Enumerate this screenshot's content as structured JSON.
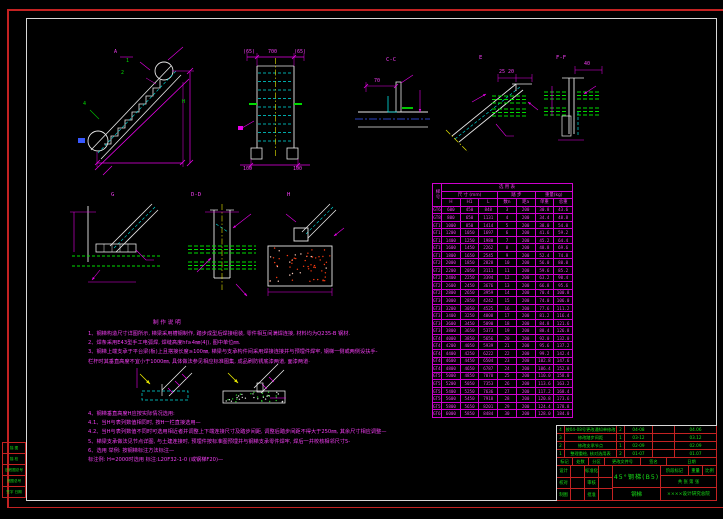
{
  "colors": {
    "background": "#000000",
    "linework_white": "#e8e8e8",
    "dimension_magenta": "#e800e8",
    "annotation_green": "#00dc00",
    "hidden_cyan": "#00e0e0",
    "centerline_yellow": "#e8e800",
    "frame_red": "#c42222",
    "titleblock_text_green": "#18e018",
    "table_magenta": "#f040f0"
  },
  "labels": {
    "elev_mark": "A",
    "balloon_1": "1",
    "balloon_2": "2",
    "balloon_4": "4",
    "dim_h": "H",
    "front_top_left": "(65)",
    "front_top_mid": "700",
    "front_top_right": "(65)",
    "front_bottom_left": "100",
    "front_bottom_right": "100",
    "sec_cc": "C-C",
    "sec_e": "E",
    "sec_ff": "F-F",
    "sec_g": "G",
    "sec_dd": "D-D",
    "sec_h": "H",
    "dim_cc": "70",
    "dim_e": "25 20",
    "dim_ff": "40"
  },
  "table": {
    "side_title": "梯号",
    "title": "选  用  表",
    "group_dims": "尺 寸 (mm)",
    "group_steps": "踏  步",
    "group_weight": "重量(kg)",
    "cols": [
      "H",
      "H1",
      "L",
      "数n",
      "距a",
      "单重",
      "总重"
    ],
    "rows": [
      [
        "GT6",
        "600",
        "450",
        "848",
        "3",
        "200",
        "30.8",
        "43.6"
      ],
      [
        "GT8",
        "800",
        "650",
        "1131",
        "4",
        "200",
        "34.4",
        "48.8"
      ],
      [
        "GT10",
        "1000",
        "850",
        "1414",
        "5",
        "200",
        "38.0",
        "54.0"
      ],
      [
        "GT12",
        "1200",
        "1050",
        "1697",
        "6",
        "200",
        "41.6",
        "59.2"
      ],
      [
        "GT14",
        "1400",
        "1250",
        "1980",
        "7",
        "200",
        "45.2",
        "64.4"
      ],
      [
        "GT16",
        "1600",
        "1450",
        "2262",
        "8",
        "200",
        "48.8",
        "69.6"
      ],
      [
        "GT18",
        "1800",
        "1650",
        "2545",
        "9",
        "200",
        "52.4",
        "74.8"
      ],
      [
        "GT20",
        "2000",
        "1850",
        "2828",
        "10",
        "200",
        "56.0",
        "80.0"
      ],
      [
        "GT22",
        "2200",
        "2050",
        "3111",
        "11",
        "200",
        "59.6",
        "85.2"
      ],
      [
        "GT24",
        "2400",
        "2250",
        "3394",
        "12",
        "200",
        "63.2",
        "90.4"
      ],
      [
        "GT26",
        "2600",
        "2450",
        "3676",
        "13",
        "200",
        "66.8",
        "95.6"
      ],
      [
        "GT28",
        "2800",
        "2650",
        "3959",
        "14",
        "200",
        "70.4",
        "100.8"
      ],
      [
        "GT30",
        "3000",
        "2850",
        "4242",
        "15",
        "200",
        "74.0",
        "106.0"
      ],
      [
        "GT32",
        "3200",
        "3050",
        "4525",
        "16",
        "200",
        "77.6",
        "111.2"
      ],
      [
        "GT34",
        "3400",
        "3250",
        "4808",
        "17",
        "200",
        "81.2",
        "116.4"
      ],
      [
        "GT36",
        "3600",
        "3450",
        "5090",
        "18",
        "200",
        "84.8",
        "121.6"
      ],
      [
        "GT38",
        "3800",
        "3650",
        "5373",
        "19",
        "200",
        "88.4",
        "126.8"
      ],
      [
        "GT40",
        "4000",
        "3850",
        "5656",
        "20",
        "200",
        "92.0",
        "132.0"
      ],
      [
        "GT42",
        "4200",
        "4050",
        "5939",
        "21",
        "200",
        "95.6",
        "137.2"
      ],
      [
        "GT44",
        "4400",
        "4250",
        "6222",
        "22",
        "200",
        "99.2",
        "142.4"
      ],
      [
        "GT46",
        "4600",
        "4450",
        "6504",
        "23",
        "200",
        "102.8",
        "147.6"
      ],
      [
        "GT48",
        "4800",
        "4650",
        "6787",
        "24",
        "200",
        "106.4",
        "152.8"
      ],
      [
        "GT50",
        "5000",
        "4850",
        "7070",
        "25",
        "200",
        "110.0",
        "158.0"
      ],
      [
        "GT52",
        "5200",
        "5050",
        "7353",
        "26",
        "200",
        "113.6",
        "163.2"
      ],
      [
        "GT54",
        "5400",
        "5250",
        "7636",
        "27",
        "200",
        "117.2",
        "168.4"
      ],
      [
        "GT56",
        "5600",
        "5450",
        "7918",
        "28",
        "200",
        "120.8",
        "173.6"
      ],
      [
        "GT58",
        "5800",
        "5650",
        "8201",
        "29",
        "200",
        "124.4",
        "178.8"
      ],
      [
        "GT60",
        "6000",
        "5850",
        "8484",
        "30",
        "200",
        "128.0",
        "184.0"
      ]
    ]
  },
  "notes": {
    "heading": "制 作 说 明",
    "sec1": [
      "1、钢梯构造尺寸详图所示, 梯梁采用槽钢制作, 踏步成型后焊接组装, 零件相互间满焊连接, 材料均为Q235-B 钢材.",
      "2、焊条采用E43型手工电弧焊, 焊缝高度hf≥4㎜(4|), 图中单位㎜.",
      "3、钢梯上端支承于平台梁(板)上且搭接长度≥100㎜, 梯梁与支承构件间采用焊接连接并与预埋件焊牢, 钢梯一侧或两侧设扶手-",
      "      栏杆时其垂直高度不宜小于1000㎜, 具体做法参见相应标准图集, 成品刷防锈底漆两道, 面漆两道·"
    ],
    "sec2": [
      "4、钢梯垂直高度H应按实际情况选用:",
      "4.1、当H与表列数值相同时, 按H一栏直接选用—",
      "4.2、当H与表列数值不同时可选用相近者并调整上下端连接尺寸及踏步间距, 调整后踏步间距不得大于250㎜, 其余尺寸相应调整—",
      "5、梯梁支承做法见节点详图, 与土建连接时, 预埋件按标准图预埋并与钢梯支承零件焊牢, 焊后一并校核相邻尺寸5-",
      "6、选用 举例: 按钢梯标注方法标注—",
      "标注例:  H=2000时选用   标注:L20F32-1-0  (或钢梯F20)—"
    ]
  },
  "titleblock": {
    "rev_rows": [
      {
        "no": "4",
        "desc": "按04-08号更改通知单修改",
        "qty": "2",
        "doc": "04-08",
        "sign": "",
        "date": "04.06"
      },
      {
        "no": "3",
        "desc": "修改踏步间距",
        "qty": "1",
        "doc": "03-12",
        "sign": "",
        "date": "03.12"
      },
      {
        "no": "2",
        "desc": "修改支承节点",
        "qty": "1",
        "doc": "02-09",
        "sign": "",
        "date": "02.09"
      },
      {
        "no": "1",
        "desc": "整理重绘, 核对选用表",
        "qty": "2",
        "doc": "01-07",
        "sign": "",
        "date": "01.07"
      }
    ],
    "change_cols": [
      "标记",
      "处数",
      "分区",
      "更改文件号",
      "签名",
      "日期"
    ],
    "sig_rows": [
      [
        "设计",
        "",
        "标准化",
        ""
      ],
      [
        "校对",
        "",
        "审核",
        ""
      ],
      [
        "制图",
        "",
        "批准",
        ""
      ]
    ],
    "title_main": "45°钢梯(B5)",
    "title_sub": "钢梯",
    "stage": "阶段标记",
    "weight": "重量",
    "scale": "比例",
    "sheets": "共 张 第 张",
    "company": "××××设计研究总院"
  },
  "margin": {
    "rows": [
      "描 图",
      "描 校",
      "旧底图总号",
      "底图总号",
      "签字 日期"
    ]
  }
}
